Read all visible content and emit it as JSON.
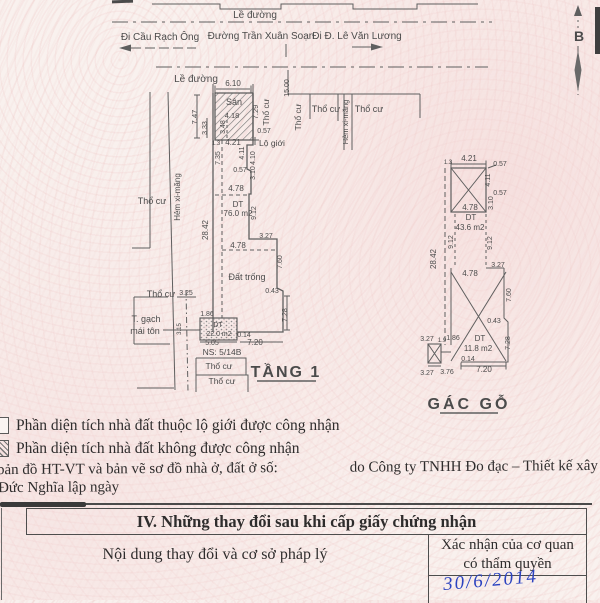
{
  "meta": {
    "paper": "#f9f1ee",
    "ink": "#4b4b4b",
    "line": "#5f5f5f",
    "blue": "#2c43c0"
  },
  "drawing": {
    "labels": [
      {
        "n": "sidewalk-label",
        "t": "Lề đường",
        "x": 255,
        "y": 18,
        "s": 10
      },
      {
        "n": "street-direction-label",
        "t": "Đi Cầu Rạch Ông",
        "x": 160,
        "y": 40,
        "s": 10
      },
      {
        "n": "street-name-label",
        "t": "Đường Trần Xuân Soạn",
        "x": 261,
        "y": 39,
        "s": 10
      },
      {
        "n": "street-direction-label",
        "t": "Đi Đ. Lê Văn Lương",
        "x": 357,
        "y": 39,
        "s": 10
      },
      {
        "n": "sidewalk-label",
        "t": "Lề đường",
        "x": 196,
        "y": 82,
        "s": 10
      },
      {
        "n": "north-label",
        "t": "B",
        "x": 579,
        "y": 41,
        "s": 14,
        "b": 1
      },
      {
        "n": "dim-label",
        "t": "6.10",
        "x": 233,
        "y": 86,
        "s": 8
      },
      {
        "n": "dim-label",
        "t": "15.00",
        "x": 289,
        "y": 88,
        "r": -90,
        "s": 7
      },
      {
        "n": "zone-label",
        "t": "Sân",
        "x": 234,
        "y": 105,
        "s": 9
      },
      {
        "n": "dim-label",
        "t": "4.18",
        "x": 232,
        "y": 118,
        "s": 7.5
      },
      {
        "n": "dim-label",
        "t": "7.47",
        "x": 197,
        "y": 117,
        "r": -90,
        "s": 7.5
      },
      {
        "n": "dim-label",
        "t": "3.33",
        "x": 207,
        "y": 128,
        "r": -90,
        "s": 7
      },
      {
        "n": "dim-label",
        "t": "3.48",
        "x": 225,
        "y": 127,
        "r": -90,
        "s": 7
      },
      {
        "n": "dim-label",
        "t": "7.29",
        "x": 258,
        "y": 112,
        "r": -90,
        "s": 7.5
      },
      {
        "n": "land-use-label",
        "t": "Thổ cư",
        "x": 269,
        "y": 112,
        "r": -90,
        "s": 8.5
      },
      {
        "n": "land-use-label",
        "t": "Thổ cư",
        "x": 301,
        "y": 117,
        "r": -90,
        "s": 8.5
      },
      {
        "n": "land-use-label",
        "t": "Thổ cư",
        "x": 326,
        "y": 112,
        "s": 9
      },
      {
        "n": "alley-label",
        "t": "Hẻm xi-măng",
        "x": 348,
        "y": 122,
        "r": -90,
        "s": 7.5
      },
      {
        "n": "land-use-label",
        "t": "Thổ cư",
        "x": 369,
        "y": 112,
        "s": 9
      },
      {
        "n": "dim-label",
        "t": "0.57",
        "x": 264,
        "y": 133,
        "s": 7
      },
      {
        "n": "dim-label",
        "t": "1.3",
        "x": 216,
        "y": 145,
        "s": 6
      },
      {
        "n": "dim-label",
        "t": "4.21",
        "x": 233,
        "y": 145,
        "s": 8
      },
      {
        "n": "boundary-label",
        "t": "Lộ giới",
        "x": 272,
        "y": 146,
        "s": 8.5
      },
      {
        "n": "dim-label",
        "t": "4.11",
        "x": 244,
        "y": 153,
        "r": -90,
        "s": 7
      },
      {
        "n": "dim-label",
        "t": "4.10",
        "x": 255,
        "y": 158,
        "r": -90,
        "s": 7
      },
      {
        "n": "dim-label",
        "t": "7.35",
        "x": 220,
        "y": 158,
        "r": -90,
        "s": 7
      },
      {
        "n": "dim-label",
        "t": "0.57",
        "x": 240,
        "y": 172,
        "s": 7
      },
      {
        "n": "dim-label",
        "t": "3.10",
        "x": 255,
        "y": 173,
        "r": -90,
        "s": 7
      },
      {
        "n": "dim-label",
        "t": "4.78",
        "x": 236,
        "y": 191,
        "s": 8
      },
      {
        "n": "area-label",
        "t": "DT",
        "x": 238,
        "y": 207,
        "s": 8
      },
      {
        "n": "area-label",
        "t": "76.0 m2",
        "x": 238,
        "y": 216,
        "s": 8
      },
      {
        "n": "dim-label",
        "t": "9.12",
        "x": 256,
        "y": 213,
        "r": -90,
        "s": 7
      },
      {
        "n": "dim-label",
        "t": "28.42",
        "x": 208,
        "y": 230,
        "r": -90,
        "s": 8
      },
      {
        "n": "dim-label",
        "t": "3.27",
        "x": 266,
        "y": 238,
        "s": 7
      },
      {
        "n": "dim-label",
        "t": "4.78",
        "x": 238,
        "y": 248,
        "s": 8
      },
      {
        "n": "zone-label",
        "t": "Đất trống",
        "x": 247,
        "y": 280,
        "s": 9
      },
      {
        "n": "dim-label",
        "t": "7.60",
        "x": 282,
        "y": 262,
        "r": -90,
        "s": 7
      },
      {
        "n": "dim-label",
        "t": "0.43",
        "x": 272,
        "y": 293,
        "s": 7
      },
      {
        "n": "land-use-label",
        "t": "Thổ cư",
        "x": 152,
        "y": 204,
        "s": 9
      },
      {
        "n": "alley-label",
        "t": "Hẻm xi-măng",
        "x": 180,
        "y": 197,
        "r": -90,
        "s": 8
      },
      {
        "n": "land-use-label",
        "t": "Thổ cư",
        "x": 161,
        "y": 297,
        "s": 9
      },
      {
        "n": "dim-label",
        "t": "3.25",
        "x": 186,
        "y": 295,
        "s": 7
      },
      {
        "n": "structure-label",
        "t": "T. gạch",
        "x": 146,
        "y": 322,
        "s": 9
      },
      {
        "n": "structure-label",
        "t": "mái tôn",
        "x": 145,
        "y": 334,
        "s": 9
      },
      {
        "n": "dim-label",
        "t": "3.15",
        "x": 181,
        "y": 329,
        "r": -90,
        "s": 6
      },
      {
        "n": "dim-label",
        "t": "1.86",
        "x": 207,
        "y": 316,
        "s": 7
      },
      {
        "n": "area-label",
        "t": "DT",
        "x": 218,
        "y": 327,
        "s": 7
      },
      {
        "n": "area-label",
        "t": "22.0 m2",
        "x": 219,
        "y": 336,
        "s": 7
      },
      {
        "n": "dim-label",
        "t": "0.14",
        "x": 244,
        "y": 337,
        "s": 7
      },
      {
        "n": "dim-label",
        "t": "5.05",
        "x": 212,
        "y": 345,
        "s": 7
      },
      {
        "n": "dim-label",
        "t": "7.20",
        "x": 255,
        "y": 345,
        "s": 8
      },
      {
        "n": "dim-label",
        "t": "7.28",
        "x": 287,
        "y": 315,
        "r": -90,
        "s": 7
      },
      {
        "n": "house-number-label",
        "t": "NS: 5/14B",
        "x": 222,
        "y": 355,
        "s": 8.5
      },
      {
        "n": "land-use-label",
        "t": "Thổ cư",
        "x": 219,
        "y": 369,
        "s": 8.5
      },
      {
        "n": "land-use-label",
        "t": "Thổ cư",
        "x": 222,
        "y": 384,
        "s": 8.5
      },
      {
        "n": "plan1-title",
        "t": "TẦNG 1",
        "x": 286,
        "y": 377,
        "s": 16,
        "b": 1,
        "ls": 2
      },
      {
        "n": "dim-label",
        "t": "1.3",
        "x": 448,
        "y": 164,
        "s": 6
      },
      {
        "n": "dim-label",
        "t": "4.21",
        "x": 469,
        "y": 161,
        "s": 8
      },
      {
        "n": "dim-label",
        "t": "0.57",
        "x": 500,
        "y": 166,
        "s": 7
      },
      {
        "n": "dim-label",
        "t": "4.11",
        "x": 490,
        "y": 180,
        "r": -90,
        "s": 7
      },
      {
        "n": "dim-label",
        "t": "0.57",
        "x": 500,
        "y": 195,
        "s": 7
      },
      {
        "n": "dim-label",
        "t": "3.10",
        "x": 493,
        "y": 203,
        "r": -90,
        "s": 7
      },
      {
        "n": "dim-label",
        "t": "4.78",
        "x": 470,
        "y": 210,
        "s": 8
      },
      {
        "n": "area-label",
        "t": "DT",
        "x": 471,
        "y": 220,
        "s": 8
      },
      {
        "n": "area-label",
        "t": "43.6 m2",
        "x": 470,
        "y": 230,
        "s": 8
      },
      {
        "n": "dim-label",
        "t": "9.12",
        "x": 453,
        "y": 242,
        "r": -90,
        "s": 7
      },
      {
        "n": "dim-label",
        "t": "9.12",
        "x": 492,
        "y": 243,
        "r": -90,
        "s": 7
      },
      {
        "n": "dim-label",
        "t": "28.42",
        "x": 436,
        "y": 259,
        "r": -90,
        "s": 8
      },
      {
        "n": "dim-label",
        "t": "3.27",
        "x": 498,
        "y": 267,
        "s": 7
      },
      {
        "n": "dim-label",
        "t": "4.78",
        "x": 470,
        "y": 276,
        "s": 8
      },
      {
        "n": "dim-label",
        "t": "7.60",
        "x": 511,
        "y": 295,
        "r": -90,
        "s": 7
      },
      {
        "n": "dim-label",
        "t": "0.43",
        "x": 494,
        "y": 323,
        "s": 7
      },
      {
        "n": "dim-label",
        "t": "7.28",
        "x": 510,
        "y": 343,
        "r": -90,
        "s": 7
      },
      {
        "n": "dim-label",
        "t": "3.27",
        "x": 427,
        "y": 341,
        "s": 7
      },
      {
        "n": "dim-label",
        "t": "1.9",
        "x": 442,
        "y": 342,
        "s": 6
      },
      {
        "n": "dim-label",
        "t": "1.86",
        "x": 453,
        "y": 340,
        "s": 7
      },
      {
        "n": "area-label",
        "t": "DT",
        "x": 480,
        "y": 341,
        "s": 8
      },
      {
        "n": "area-label",
        "t": "11.8 m2",
        "x": 478,
        "y": 351,
        "s": 8
      },
      {
        "n": "dim-label",
        "t": "0.14",
        "x": 468,
        "y": 361,
        "s": 7
      },
      {
        "n": "dim-label",
        "t": "3.27",
        "x": 427,
        "y": 375,
        "s": 7
      },
      {
        "n": "dim-label",
        "t": "3.76",
        "x": 447,
        "y": 374,
        "s": 7
      },
      {
        "n": "dim-label",
        "t": "7.20",
        "x": 484,
        "y": 372,
        "s": 8
      },
      {
        "n": "plan2-title",
        "t": "GÁC GỖ",
        "x": 469,
        "y": 409,
        "s": 16,
        "b": 1,
        "ls": 3
      }
    ]
  },
  "legend": {
    "items": [
      {
        "text": "Phần diện tích nhà đất thuộc lộ giới được công nhận",
        "swatch": "empty"
      },
      {
        "text": "Phần diện tích nhà đất không được công nhận",
        "swatch": "hatched"
      }
    ]
  },
  "notes": {
    "line1_left": "bản đồ HT-VT và bản vẽ sơ đồ nhà ở, đất ở số:",
    "line1_right": "do Công ty TNHH Đo đạc – Thiết kế xây dựng",
    "line2": "Đức Nghĩa lập ngày"
  },
  "table": {
    "section_title": "IV. Những thay đổi sau khi cấp giấy chứng nhận",
    "col1_header": "Nội dung thay đổi và cơ sở pháp lý",
    "col2_header": "Xác nhận của cơ quan có thẩm quyền",
    "handwritten_date": "30/6/2014"
  }
}
